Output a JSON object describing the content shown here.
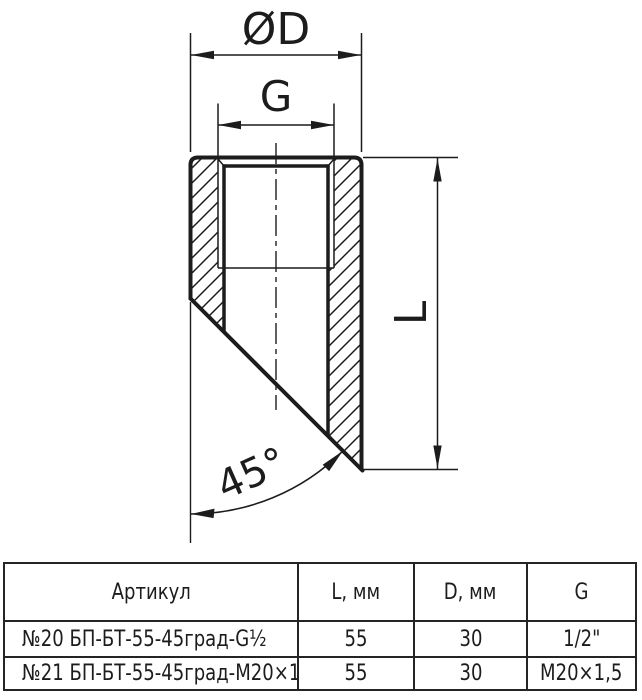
{
  "drawing": {
    "diameter_label": "ØD",
    "thread_label": "G",
    "length_label": "L",
    "angle_label": "45°"
  },
  "table": {
    "headers": [
      "Артикул",
      "L, мм",
      "D, мм",
      "G"
    ],
    "rows": [
      [
        "№20 БП-БТ-55-45град-G½",
        "55",
        "30",
        "1/2\""
      ],
      [
        "№21 БП-БТ-55-45град-М20×1,5",
        "55",
        "30",
        "М20×1,5"
      ]
    ]
  },
  "colors": {
    "line": "#1c1c1c",
    "table_border": "#242424",
    "background": "#ffffff"
  }
}
